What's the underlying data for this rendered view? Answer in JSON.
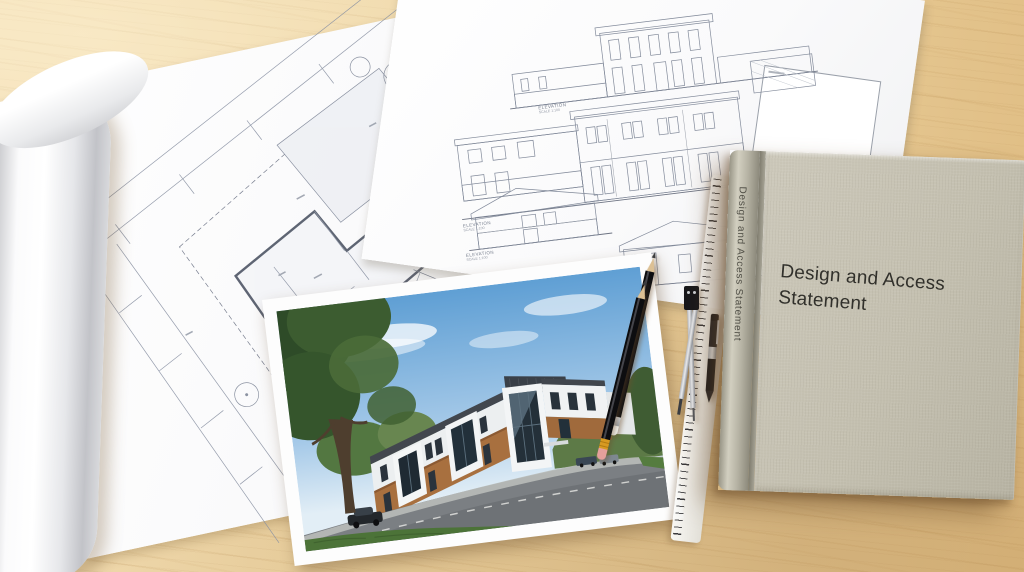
{
  "book": {
    "cover_title_lines": [
      "Design and Access",
      "Statement"
    ],
    "spine_text": "Design and Access Statement",
    "cover_color": "#c7c3b4",
    "title_color": "#31302b"
  },
  "site_plan": {
    "north_label": "N"
  },
  "elevation_sheet": {
    "labels": [
      {
        "title": "ELEVATION",
        "subtitle": "SCALE 1:100"
      },
      {
        "title": "ELEVATION",
        "subtitle": "SCALE 1:100"
      },
      {
        "title": "ELEVATION",
        "subtitle": "SCALE 1:100"
      }
    ]
  },
  "palette": {
    "desk_wood": "#e9cf9e",
    "paper": "#fbfbfc",
    "photo_sky": "#6ba6d9",
    "photo_brick": "#a8703f",
    "photo_roof": "#3e434a",
    "photo_grass": "#4c7338"
  }
}
